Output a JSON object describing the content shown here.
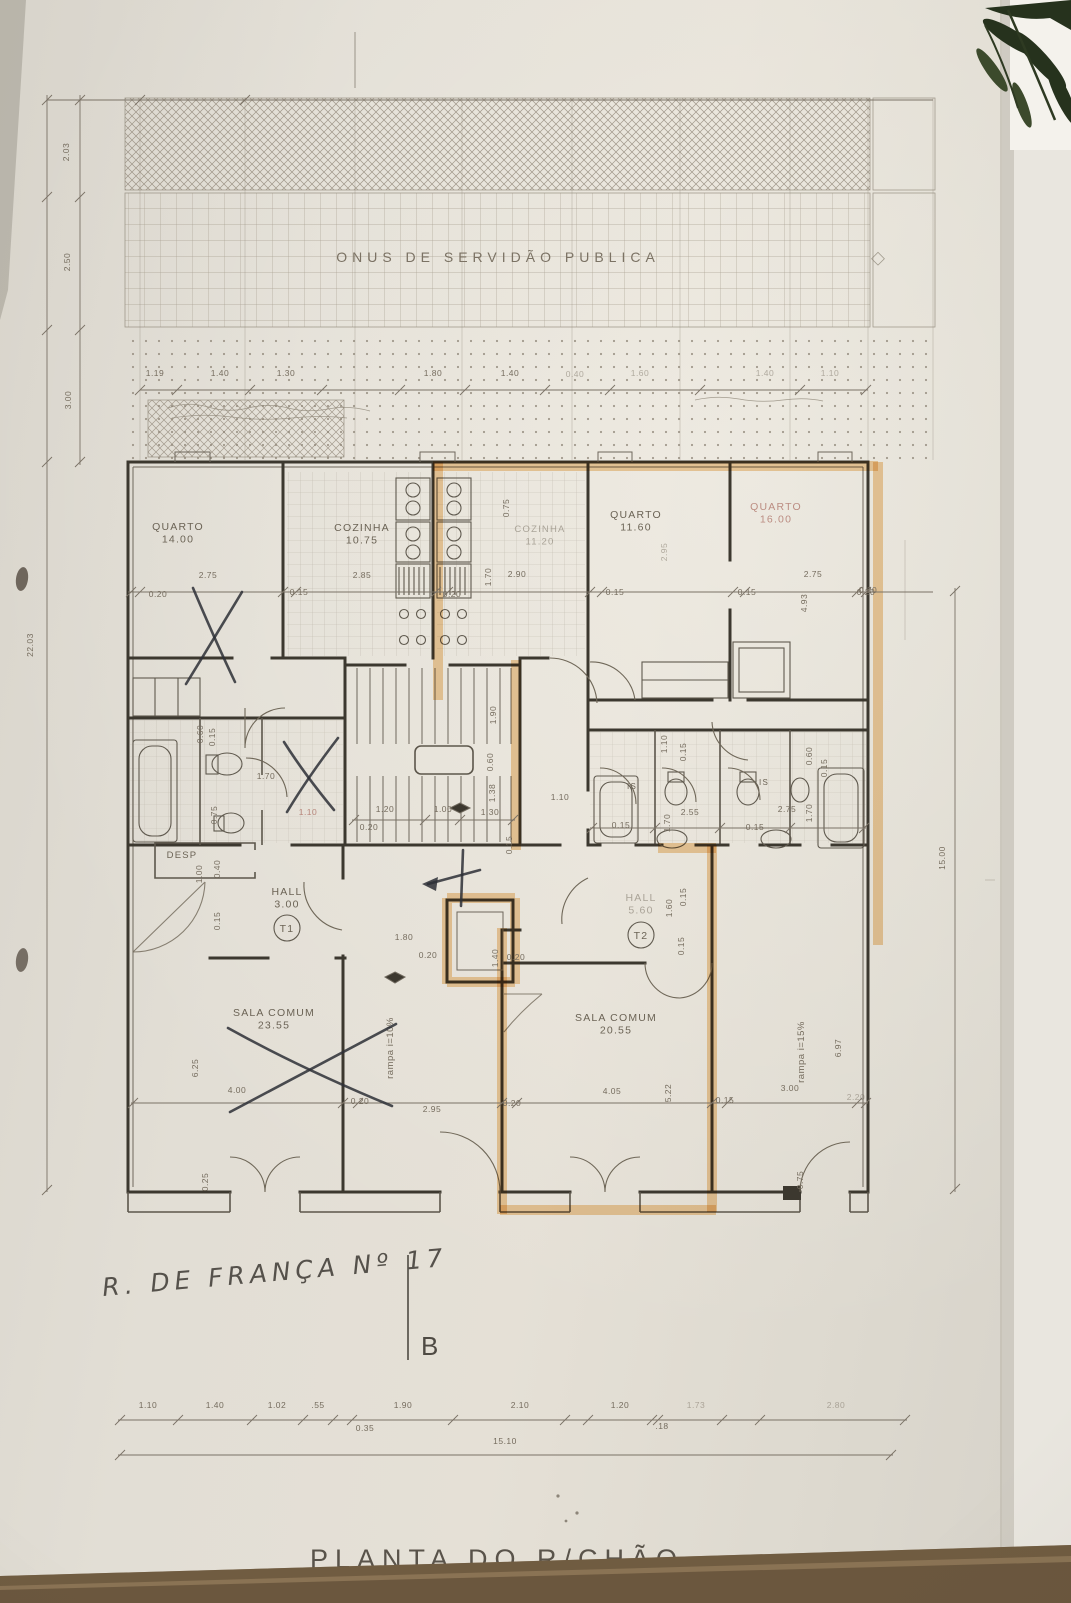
{
  "photo": {
    "plan_title": "PLANTA DO R/CHÃO",
    "handwritten_address": "R. DE FRANÇA Nº 17",
    "section_marker": "B",
    "servitude_label": "ONUS DE SERVIDÃO PUBLICA"
  },
  "colors": {
    "paper": "#dfdbd2",
    "pencil_line": "#8a8173",
    "wall_line": "#3c382f",
    "highlighter": "#e8a84e",
    "pen_mark": "#2d2f36",
    "faded_red_label": "#b0766b",
    "table": "#6b573e",
    "plant": "#26321d"
  },
  "rooms": [
    {
      "t": "QUARTO",
      "a": "14.00",
      "x": 178,
      "y": 530
    },
    {
      "t": "COZINHA",
      "a": "10.75",
      "x": 362,
      "y": 531
    },
    {
      "t": "COZINHA",
      "a": "11.20",
      "x": 540,
      "y": 532,
      "c": "faint",
      "s": 9.5
    },
    {
      "t": "QUARTO",
      "a": "11.60",
      "x": 636,
      "y": 518
    },
    {
      "t": "QUARTO",
      "a": "16.00",
      "x": 776,
      "y": 510,
      "c": "faded"
    },
    {
      "t": "HALL",
      "a": "3.00",
      "x": 287,
      "y": 895
    },
    {
      "t": "HALL",
      "a": "5.60",
      "x": 641,
      "y": 901,
      "c": "faint"
    },
    {
      "t": "SALA COMUM",
      "a": "23.55",
      "x": 274,
      "y": 1016
    },
    {
      "t": "SALA COMUM",
      "a": "20.55",
      "x": 616,
      "y": 1021
    },
    {
      "t": "DESP",
      "a": "",
      "x": 182,
      "y": 858,
      "s": 9.5
    },
    {
      "t": "IS",
      "a": "",
      "x": 632,
      "y": 789,
      "s": 8
    },
    {
      "t": "IS",
      "a": "",
      "x": 764,
      "y": 785,
      "s": 8
    }
  ],
  "unit_markers": [
    {
      "t": "T1",
      "x": 287,
      "y": 928
    },
    {
      "t": "T2",
      "x": 641,
      "y": 935
    }
  ],
  "ramps": [
    {
      "t": "rampa i=10%",
      "x": 393,
      "y": 1048
    },
    {
      "t": "rampa i=15%",
      "x": 804,
      "y": 1052
    }
  ],
  "dims": [
    {
      "x": 69,
      "y": 152,
      "t": "2.03",
      "r": -90
    },
    {
      "x": 70,
      "y": 262,
      "t": "2.50",
      "r": -90
    },
    {
      "x": 71,
      "y": 400,
      "t": "3.00",
      "r": -90
    },
    {
      "x": 33,
      "y": 645,
      "t": "22.03",
      "r": -90
    },
    {
      "x": 155,
      "y": 376,
      "t": "1.19"
    },
    {
      "x": 220,
      "y": 376,
      "t": "1.40"
    },
    {
      "x": 286,
      "y": 376,
      "t": "1.30"
    },
    {
      "x": 433,
      "y": 376,
      "t": "1.80"
    },
    {
      "x": 510,
      "y": 376,
      "t": "1.40"
    },
    {
      "x": 575,
      "y": 377,
      "t": "0.40",
      "c": "faint"
    },
    {
      "x": 640,
      "y": 376,
      "t": "1.60",
      "c": "faint"
    },
    {
      "x": 765,
      "y": 376,
      "t": "1.40",
      "c": "faint"
    },
    {
      "x": 830,
      "y": 376,
      "t": "1.10",
      "c": "faint"
    },
    {
      "x": 158,
      "y": 597,
      "t": "0.20"
    },
    {
      "x": 208,
      "y": 578,
      "t": "2.75"
    },
    {
      "x": 299,
      "y": 595,
      "t": "0.15"
    },
    {
      "x": 362,
      "y": 578,
      "t": "2.85"
    },
    {
      "x": 452,
      "y": 597,
      "t": "0.20"
    },
    {
      "x": 491,
      "y": 577,
      "t": "1.70",
      "r": -90
    },
    {
      "x": 517,
      "y": 577,
      "t": "2.90"
    },
    {
      "x": 509,
      "y": 508,
      "t": "0.75",
      "r": -90
    },
    {
      "x": 615,
      "y": 595,
      "t": "0.15"
    },
    {
      "x": 667,
      "y": 552,
      "t": "2.95",
      "r": -90,
      "c": "faint"
    },
    {
      "x": 747,
      "y": 595,
      "t": "0.15"
    },
    {
      "x": 813,
      "y": 577,
      "t": "2.75"
    },
    {
      "x": 866,
      "y": 595,
      "t": "0.20"
    },
    {
      "x": 807,
      "y": 603,
      "t": "4.93",
      "r": -90
    },
    {
      "x": 203,
      "y": 734,
      "t": "0.60",
      "r": -90
    },
    {
      "x": 215,
      "y": 737,
      "t": "0.15",
      "r": -90
    },
    {
      "x": 266,
      "y": 779,
      "t": "1.70"
    },
    {
      "x": 217,
      "y": 815,
      "t": "0.75",
      "r": -90
    },
    {
      "x": 308,
      "y": 815,
      "t": "1.10",
      "c": "fadedred"
    },
    {
      "x": 369,
      "y": 830,
      "t": "0.20"
    },
    {
      "x": 385,
      "y": 812,
      "t": "1.20"
    },
    {
      "x": 443,
      "y": 812,
      "t": "1.00"
    },
    {
      "x": 490,
      "y": 815,
      "t": "1.30"
    },
    {
      "x": 496,
      "y": 715,
      "t": "1.90",
      "r": -90
    },
    {
      "x": 493,
      "y": 762,
      "t": "0.60",
      "r": -90
    },
    {
      "x": 495,
      "y": 793,
      "t": "1.38",
      "r": -90
    },
    {
      "x": 512,
      "y": 845,
      "t": "0.15",
      "r": -90
    },
    {
      "x": 560,
      "y": 800,
      "t": "1.10"
    },
    {
      "x": 667,
      "y": 744,
      "t": "1.10",
      "r": -90
    },
    {
      "x": 686,
      "y": 752,
      "t": "0.15",
      "r": -90
    },
    {
      "x": 812,
      "y": 756,
      "t": "0.60",
      "r": -90
    },
    {
      "x": 827,
      "y": 768,
      "t": "0.15",
      "r": -90
    },
    {
      "x": 690,
      "y": 815,
      "t": "2.55"
    },
    {
      "x": 670,
      "y": 823,
      "t": "1.70",
      "r": -90
    },
    {
      "x": 787,
      "y": 812,
      "t": "2.75"
    },
    {
      "x": 812,
      "y": 813,
      "t": "1.70",
      "r": -90
    },
    {
      "x": 621,
      "y": 828,
      "t": "0.15"
    },
    {
      "x": 755,
      "y": 830,
      "t": "0.15"
    },
    {
      "x": 202,
      "y": 874,
      "t": "1.00",
      "r": -90
    },
    {
      "x": 220,
      "y": 869,
      "t": "0.40",
      "r": -90
    },
    {
      "x": 220,
      "y": 921,
      "t": "0.15",
      "r": -90
    },
    {
      "x": 672,
      "y": 908,
      "t": "1.60",
      "r": -90
    },
    {
      "x": 686,
      "y": 897,
      "t": "0.15",
      "r": -90
    },
    {
      "x": 684,
      "y": 946,
      "t": "0.15",
      "r": -90
    },
    {
      "x": 404,
      "y": 940,
      "t": "1.80"
    },
    {
      "x": 428,
      "y": 958,
      "t": "0.20"
    },
    {
      "x": 498,
      "y": 958,
      "t": "1.40",
      "r": -90
    },
    {
      "x": 516,
      "y": 960,
      "t": "0.20"
    },
    {
      "x": 868,
      "y": 593,
      "t": "0.20"
    },
    {
      "x": 198,
      "y": 1068,
      "t": "6.25",
      "r": -90
    },
    {
      "x": 237,
      "y": 1093,
      "t": "4.00"
    },
    {
      "x": 360,
      "y": 1104,
      "t": "0.20"
    },
    {
      "x": 432,
      "y": 1112,
      "t": "2.95"
    },
    {
      "x": 512,
      "y": 1106,
      "t": "0.20"
    },
    {
      "x": 612,
      "y": 1094,
      "t": "4.05"
    },
    {
      "x": 671,
      "y": 1093,
      "t": "5.22",
      "r": -90
    },
    {
      "x": 725,
      "y": 1103,
      "t": "0.15"
    },
    {
      "x": 790,
      "y": 1091,
      "t": "3.00"
    },
    {
      "x": 856,
      "y": 1100,
      "t": "2.20",
      "c": "faint"
    },
    {
      "x": 841,
      "y": 1048,
      "t": "6.97",
      "r": -90
    },
    {
      "x": 208,
      "y": 1182,
      "t": "0.25",
      "r": -90
    },
    {
      "x": 803,
      "y": 1180,
      "t": "0.75",
      "r": -90
    },
    {
      "x": 945,
      "y": 858,
      "t": "15.00",
      "r": -90
    },
    {
      "x": 148,
      "y": 1408,
      "t": "1.10"
    },
    {
      "x": 215,
      "y": 1408,
      "t": "1.40"
    },
    {
      "x": 277,
      "y": 1408,
      "t": "1.02"
    },
    {
      "x": 318,
      "y": 1408,
      "t": ".55"
    },
    {
      "x": 403,
      "y": 1408,
      "t": "1.90"
    },
    {
      "x": 520,
      "y": 1408,
      "t": "2.10"
    },
    {
      "x": 620,
      "y": 1408,
      "t": "1.20"
    },
    {
      "x": 696,
      "y": 1408,
      "t": "1.73",
      "c": "faint"
    },
    {
      "x": 836,
      "y": 1408,
      "t": "2.80",
      "c": "faint"
    },
    {
      "x": 365,
      "y": 1431,
      "t": "0.35"
    },
    {
      "x": 662,
      "y": 1429,
      "t": ".18"
    },
    {
      "x": 505,
      "y": 1444,
      "t": "15.10"
    }
  ],
  "chains": [
    {
      "d": "h",
      "y": 1420,
      "x1": 118,
      "x2": 907,
      "ticks": [
        120,
        178,
        252,
        303,
        333,
        352,
        453,
        565,
        588,
        652,
        658,
        722,
        760,
        905
      ]
    },
    {
      "d": "h",
      "y": 1455,
      "x1": 118,
      "x2": 893,
      "ticks": [
        120,
        891
      ]
    },
    {
      "d": "v",
      "x": 47,
      "y1": 95,
      "y2": 1192,
      "ticks": [
        100,
        197,
        330,
        462,
        1190
      ]
    },
    {
      "d": "v",
      "x": 80,
      "y1": 95,
      "y2": 465,
      "ticks": [
        100,
        197,
        330,
        462
      ]
    },
    {
      "d": "v",
      "x": 955,
      "y1": 588,
      "y2": 1192,
      "ticks": [
        591,
        1189
      ]
    },
    {
      "d": "h",
      "y": 390,
      "x1": 140,
      "x2": 868,
      "ticks": [
        140,
        177,
        250,
        322,
        400,
        465,
        545,
        610,
        700,
        800,
        866
      ]
    },
    {
      "d": "h",
      "y": 100,
      "x1": 47,
      "x2": 933,
      "ticks": [
        140,
        245
      ]
    },
    {
      "d": "h",
      "y": 592,
      "x1": 128,
      "x2": 933,
      "ticks": [
        131,
        140,
        283,
        296,
        436,
        448,
        590,
        602,
        733,
        745,
        857,
        866
      ]
    },
    {
      "d": "h",
      "y": 1103,
      "x1": 131,
      "x2": 868,
      "ticks": [
        133,
        343,
        358,
        502,
        517,
        712,
        727,
        857,
        866
      ]
    },
    {
      "d": "h",
      "y": 820,
      "x1": 352,
      "x2": 515,
      "ticks": [
        354,
        425,
        460,
        513
      ]
    },
    {
      "d": "h",
      "y": 828,
      "x1": 590,
      "x2": 866,
      "ticks": [
        592,
        655,
        720,
        790,
        864
      ]
    }
  ]
}
